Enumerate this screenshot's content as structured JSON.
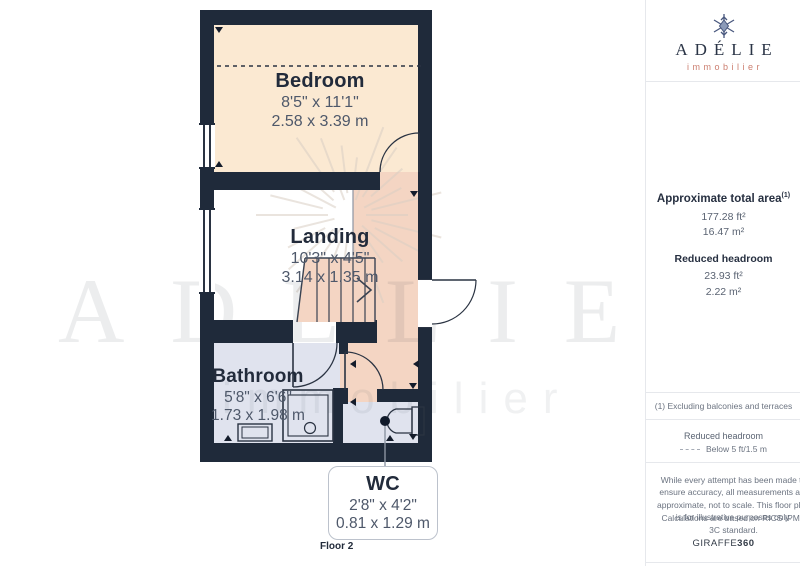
{
  "logo": {
    "brand": "ADÉLIE",
    "tagline": "immobilier"
  },
  "sidebar": {
    "area_heading": "Approximate total area",
    "area_heading_sup": "(1)",
    "total_area_ft": "177.28 ft²",
    "total_area_m": "16.47 m²",
    "reduced_heading": "Reduced headroom",
    "reduced_ft": "23.93 ft²",
    "reduced_m": "2.22 m²",
    "note": "(1) Excluding balconies and terraces",
    "legend_title": "Reduced headroom",
    "legend_label": "Below 5 ft/1.5 m",
    "disclaimer1": "While every attempt has been made to ensure accuracy, all measurements are approximate, not to scale. This floor plan is for illustrative purposes only.",
    "disclaimer2": "Calculations are based on RICS IPMS 3C standard.",
    "footer_brand_normal": "GIRAFFE",
    "footer_brand_bold": "360"
  },
  "plan": {
    "floor_label": "Floor 2",
    "rooms": {
      "bedroom": {
        "name": "Bedroom",
        "dim_ft": "8'5\" x 11'1\"",
        "dim_m": "2.58 x 3.39 m"
      },
      "landing": {
        "name": "Landing",
        "dim_ft": "10'3\" x 4'5\"",
        "dim_m": "3.14 x 1.35 m"
      },
      "bathroom": {
        "name": "Bathroom",
        "dim_ft": "5'8\" x 6'6\"",
        "dim_m": "1.73 x 1.98 m"
      },
      "wc": {
        "name": "WC",
        "dim_ft": "2'8\" x 4'2\"",
        "dim_m": "0.81 x 1.29 m"
      }
    },
    "watermark_text": "ADÉLIE",
    "watermark_subtext": "immobilier"
  },
  "colors": {
    "wall": "#1f2a3a",
    "cream": "#fbe9d2",
    "salmon": "#f4d5c3",
    "blue": "#e0e3ee",
    "line": "#2a3342",
    "dim": "#4e586a",
    "label": "#222b3b",
    "coral": "#cc7f70",
    "divider": "#e6e8ec",
    "muted": "#6b7380"
  }
}
